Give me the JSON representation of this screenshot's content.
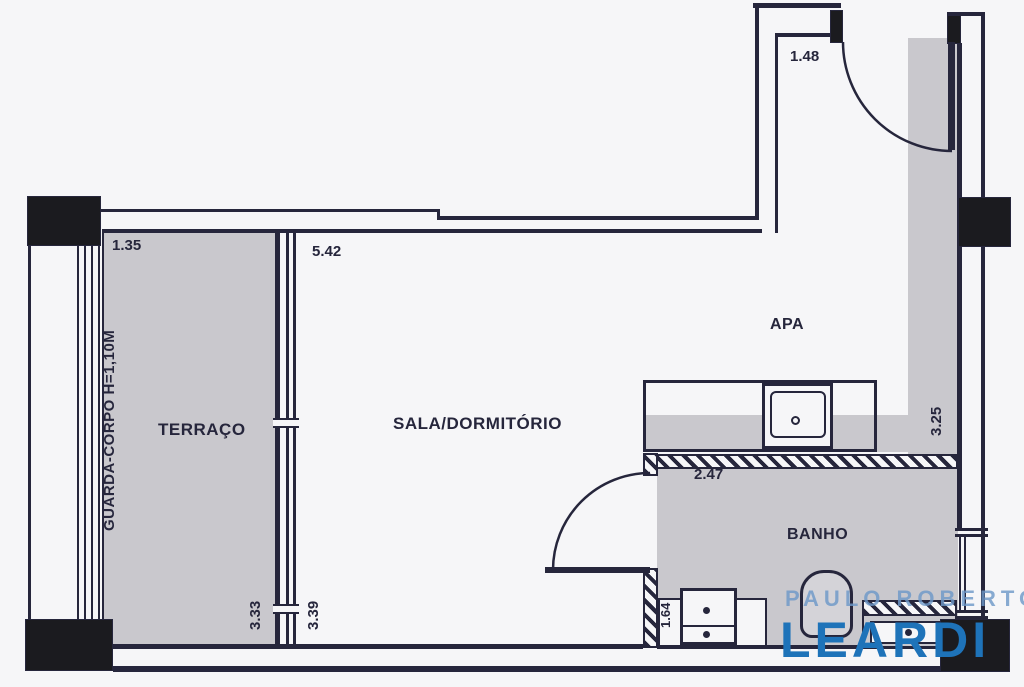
{
  "plan": {
    "rooms": {
      "terraco": "TERRAÇO",
      "sala": "SALA/DORMITÓRIO",
      "apa": "APA",
      "banho": "BANHO"
    },
    "guard_rail_note": "GUARDA-CORPO H=1,10M",
    "dims": {
      "entry_door": "1.48",
      "terraco_width": "1.35",
      "sala_width": "5.42",
      "right_wall": "3.25",
      "banho_wall": "2.47",
      "terraco_depth": "3.33",
      "sala_depth": "3.39",
      "vanity_width": "1.64"
    },
    "watermark": {
      "line1": "PAULO ROBERTO",
      "line2": "LEARDI"
    },
    "colors": {
      "line": "#26263c",
      "floor_gray": "#c9c8cd",
      "column_black": "#1b1b1f",
      "watermark_light": "#7ba3d0",
      "watermark_blue": "#1e73b9",
      "background": "#f6f6f8"
    }
  }
}
